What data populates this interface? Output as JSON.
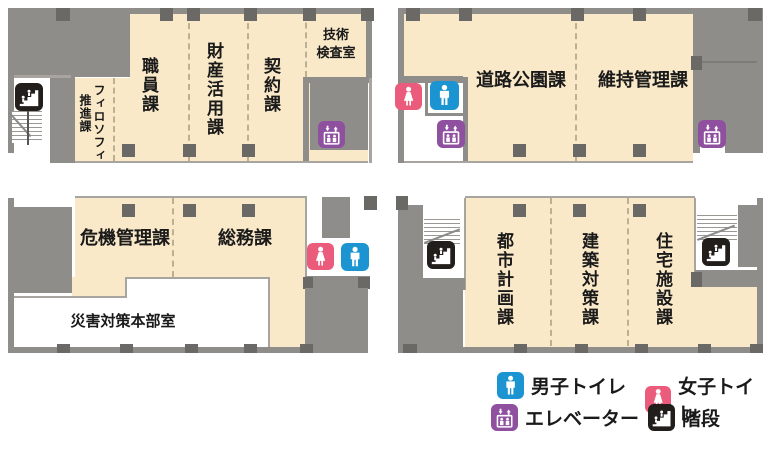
{
  "legend": {
    "male": "男子トイレ",
    "female": "女子トイレ",
    "elevator": "エレベーター",
    "stairs": "階段"
  },
  "rooms": {
    "philosophy_promotion": {
      "line1": "フィロソフィ",
      "line2": "推進課"
    },
    "staff": {
      "name": "職員課"
    },
    "property_utilization": {
      "name": "財産活用課"
    },
    "contract": {
      "name": "契約課"
    },
    "technical_inspection": {
      "line1": "技術",
      "line2": "検査室"
    },
    "road_park": {
      "name": "道路公園課"
    },
    "maintenance_mgmt": {
      "name": "維持管理課"
    },
    "crisis_mgmt": {
      "name": "危機管理課"
    },
    "general_affairs": {
      "name": "総務課"
    },
    "disaster_hq": {
      "name": "災害対策本部室"
    },
    "urban_planning": {
      "name": "都市計画課"
    },
    "building_measures": {
      "name": "建築対策課"
    },
    "housing_facilities": {
      "name": "住宅施設課"
    }
  },
  "colors": {
    "room_fill": "#FAE9C8",
    "wall": "#8F8D8A",
    "column": "#6B6966",
    "toilet_male": "#1B94D1",
    "toilet_female": "#EA5B7C",
    "elevator": "#9050A0",
    "stairs": "#221E1C"
  }
}
